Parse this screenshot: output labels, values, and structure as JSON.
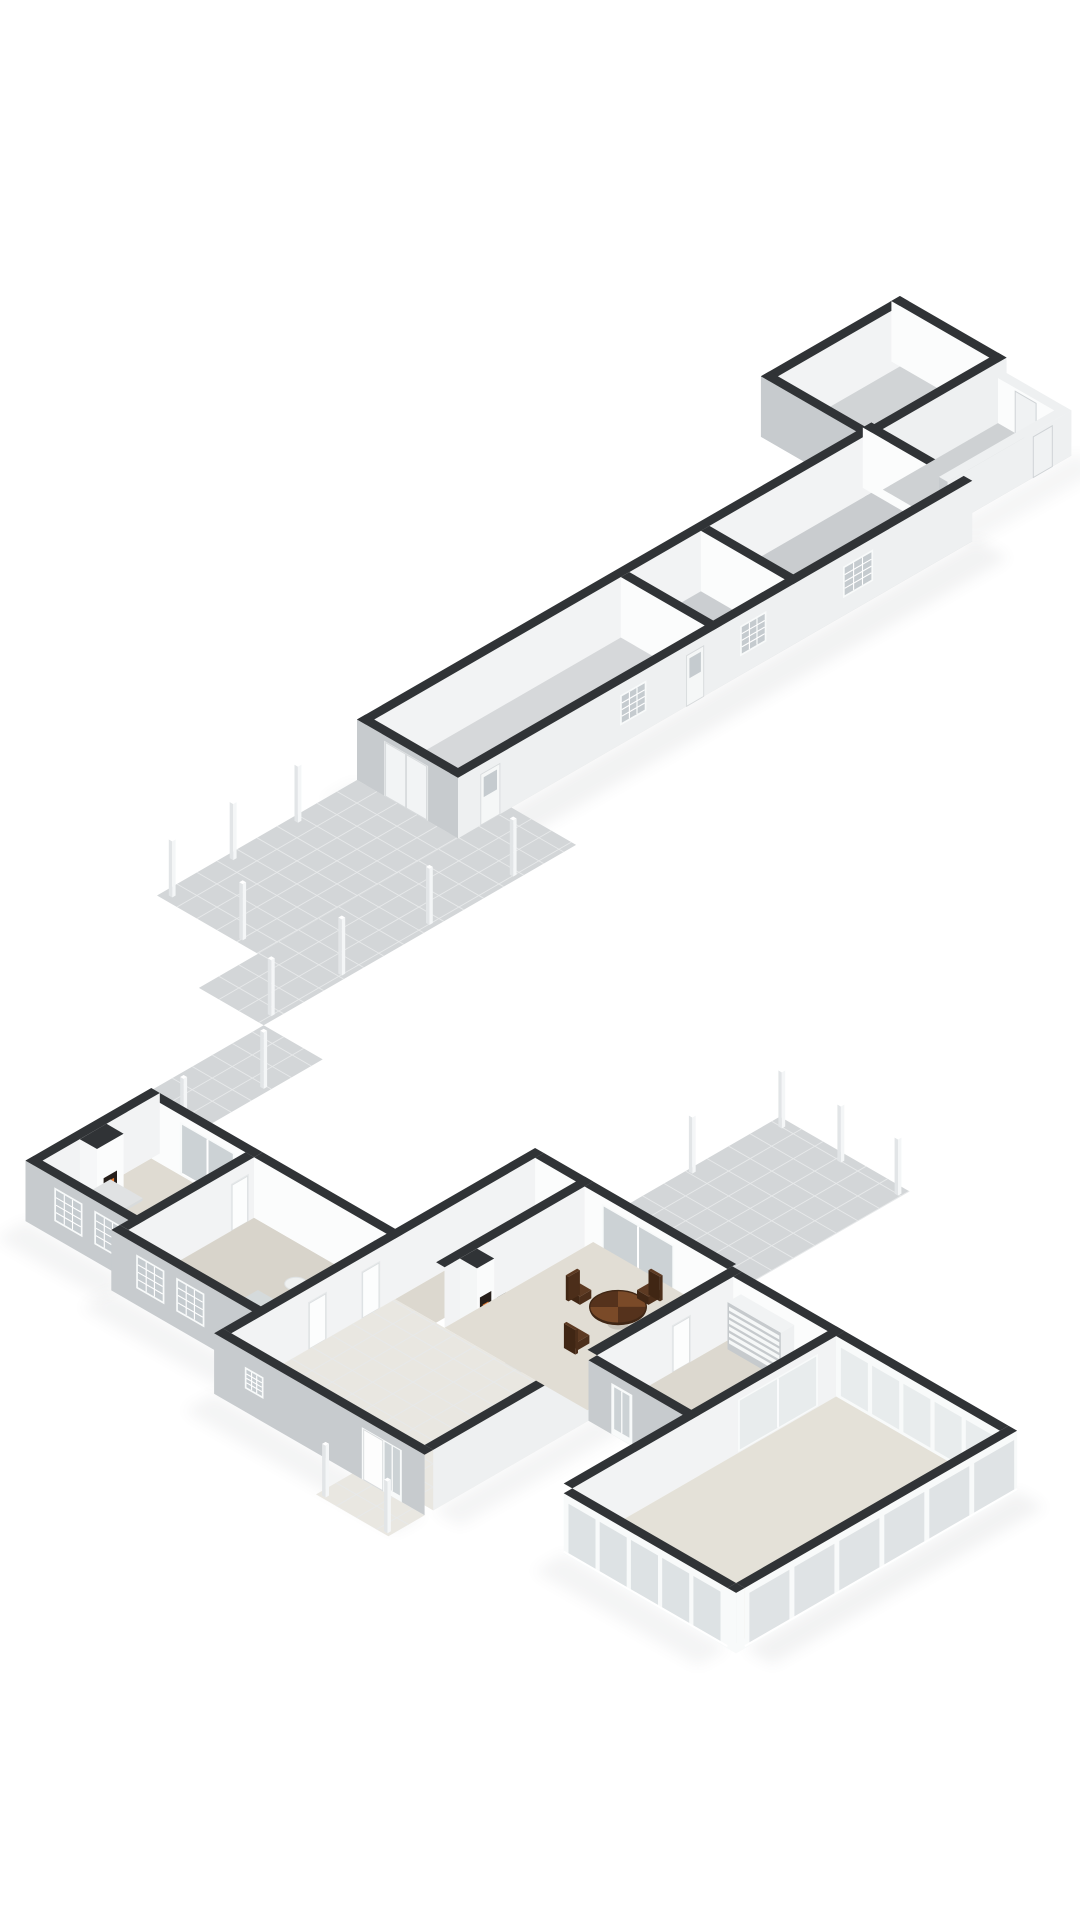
{
  "view": {
    "kind": "3d-floorplan-render",
    "projection": "isometric",
    "background": "#ffffff"
  },
  "colors": {
    "background": "#ffffff",
    "wallTop": "#303336",
    "wallTopLight": "#eef0f1",
    "extWallL": "#c7cbce",
    "extWallF": "#eef0f1",
    "intWallL": "#fbfcfc",
    "intWallF": "#f2f3f4",
    "frame": "#f8fafa",
    "glass": "#ccd2d5",
    "glassDark": "#c5cbcf",
    "glassLight": "#e8eced",
    "glassExt": "#dde2e4",
    "tile": "#d3d6d8",
    "tileLine": "#e7e9ea",
    "postL": "#e2e5e7",
    "postF": "#f4f6f7",
    "floorBarnA": "#d6d8da",
    "floorBarnB": "#cbced1",
    "floorBarnC": "#c9cccf",
    "floorBarnD": "#d1d4d6",
    "floorLean": "#ced1d3",
    "floorLiving": "#dfdbd2",
    "floorLounge": "#d8d4cb",
    "floorDining": "#e1ddd4",
    "floorRear": "#dcd8cf",
    "floorCons": "#e4e1d8",
    "floorHall": "#e9e7e1",
    "sofa": "#c6ccce",
    "sofaTop": "#d5dadb",
    "sofaSide": "#b9c0c3",
    "marble": "#eff1f1",
    "marbleEdge": "#d9dcdd",
    "woodDark": "#55321c",
    "woodMid": "#7a4a28",
    "woodRim": "#402715",
    "pedestal": "#3a2414",
    "chairTop": "#5d3a22",
    "chairL": "#402614",
    "chairF": "#4c2e1a",
    "ladder": "#e2e4e5",
    "ladderSide": "#cdd1d3",
    "fire": "#e2762b",
    "fireGlow": "#f6ac49",
    "fireDark": "#261f1b",
    "shadow": "#50555a"
  },
  "scene": {
    "structures": [
      {
        "name": "outbuilding",
        "elements": [
          "tiled-terrace",
          "pergola-posts",
          "long-room",
          "middle-room",
          "large-room",
          "end-room",
          "lean-to",
          "loft-ladder",
          "double-doors",
          "front-doors",
          "grid-windows",
          "interior-doorways"
        ]
      },
      {
        "name": "main-house",
        "elements": [
          "walkway",
          "living-room",
          "fireplace",
          "round-coffee-table",
          "sliding-door",
          "lounge",
          "sofa",
          "side-table",
          "hallway",
          "front-door",
          "entry-porch",
          "porch-posts",
          "corridor",
          "dining-room",
          "round-dining-table",
          "dining-chairs",
          "stove-niche",
          "garden-patio",
          "patio-posts",
          "rear-room",
          "louver-cabinet",
          "back-door",
          "conservatory",
          "glass-walls"
        ]
      }
    ]
  }
}
